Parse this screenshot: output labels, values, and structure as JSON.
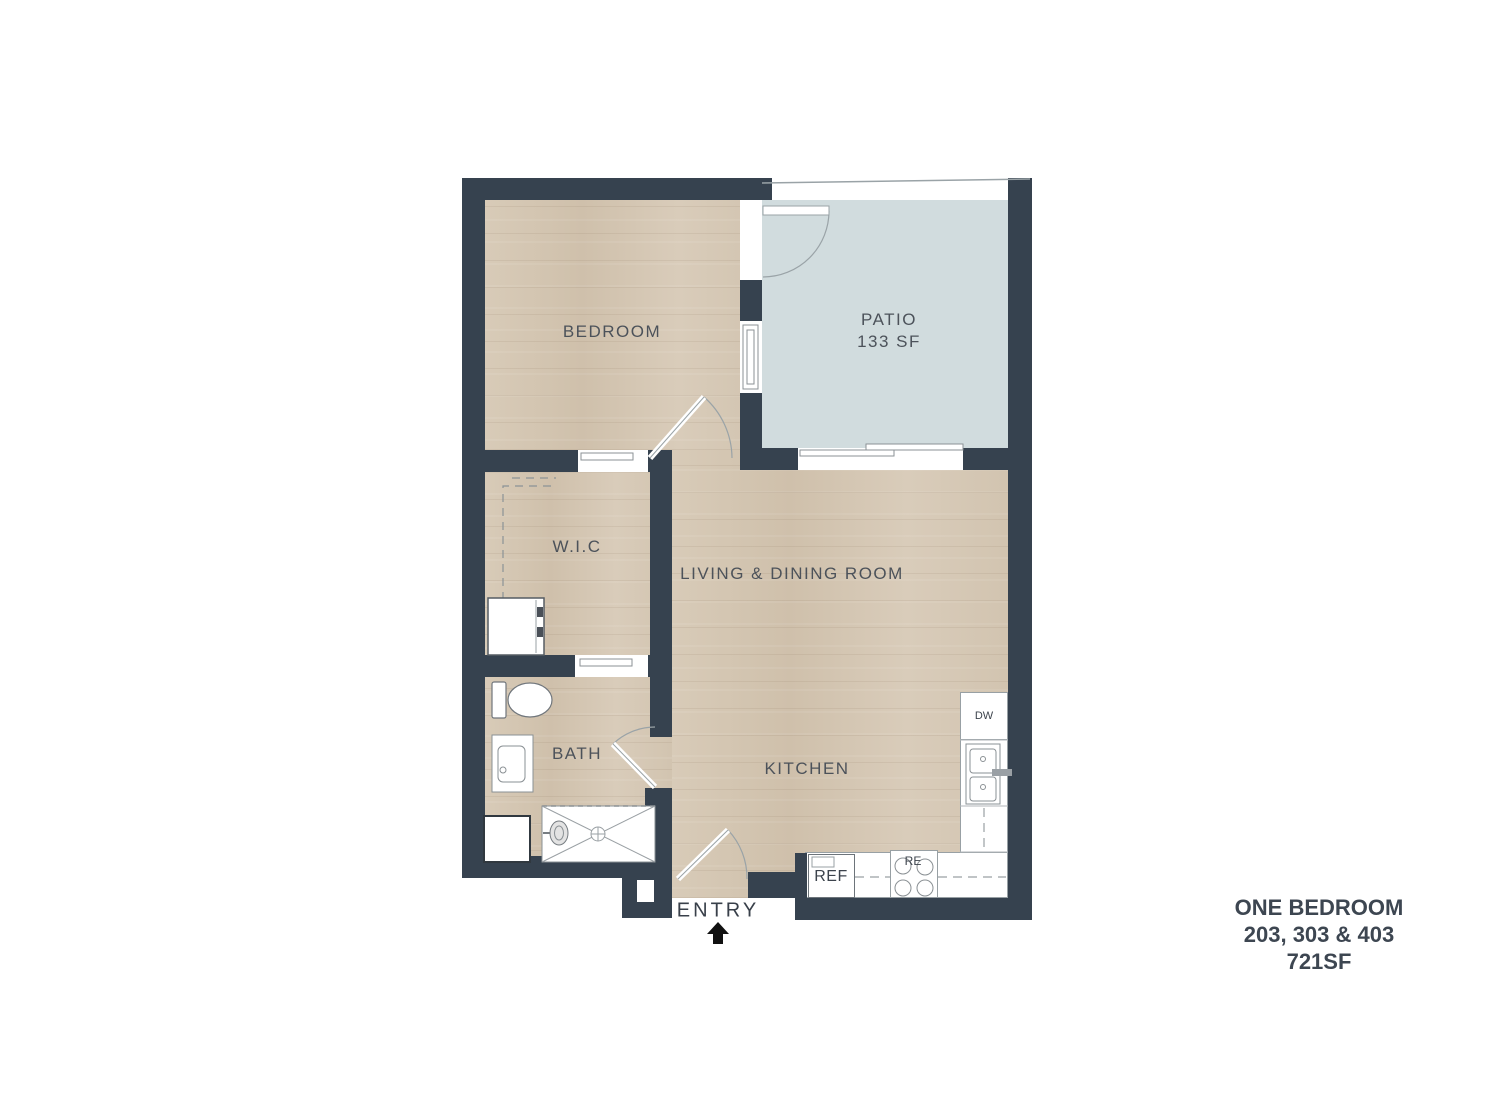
{
  "rooms": {
    "bedroom": {
      "label": "BEDROOM"
    },
    "patio": {
      "label": "PATIO",
      "area": "133 SF"
    },
    "wic": {
      "label": "W.I.C"
    },
    "living_dining": {
      "label": "LIVING & DINING ROOM"
    },
    "bath": {
      "label": "BATH"
    },
    "kitchen": {
      "label": "KITCHEN"
    }
  },
  "appliances": {
    "dishwasher": "DW",
    "refrigerator": "REF",
    "range": "RE"
  },
  "entry": {
    "label": "ENTRY"
  },
  "title_block": {
    "plan_name": "ONE BEDROOM",
    "units": "203, 303 & 403",
    "area": "721SF"
  },
  "colors": {
    "wall": "#36424f",
    "wood_floor": "#d6c8b5",
    "patio_floor": "#d1dcde",
    "label_text": "#4c525a",
    "title_text": "#3d4651",
    "line": "#8b9296"
  }
}
